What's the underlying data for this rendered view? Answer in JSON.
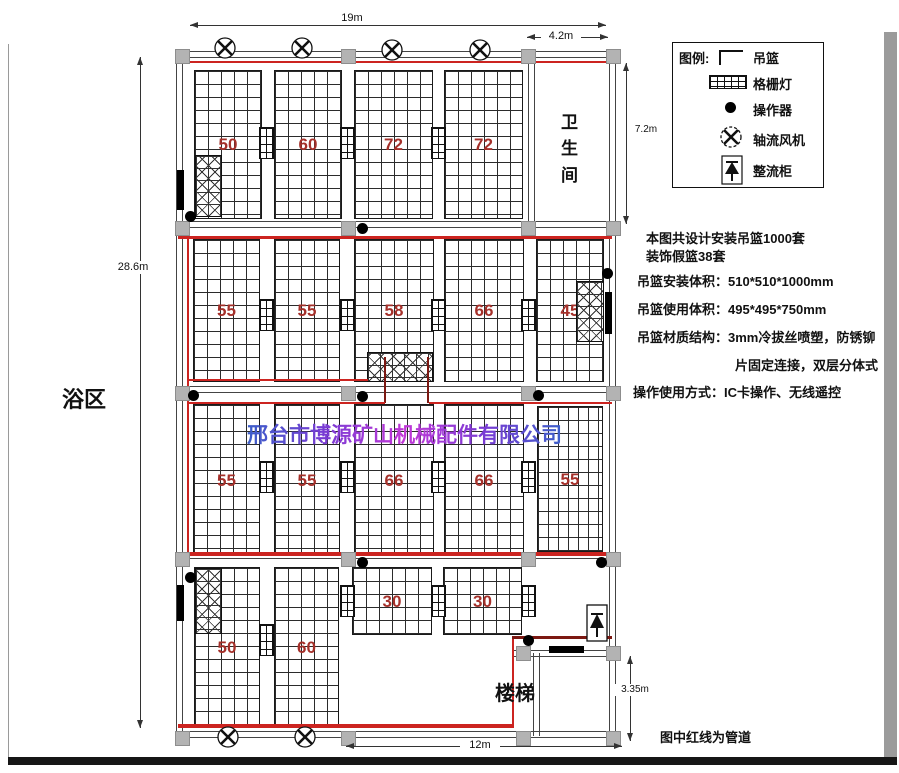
{
  "watermark": "邢台市博源矿山机械配件有限公司",
  "note": "图中红线为管道",
  "rooms": {
    "bath_area": "浴区",
    "toilet": "卫生间",
    "stairs": "楼梯"
  },
  "dims": {
    "top": "19m",
    "top_right": "4.2m",
    "right_upper": "7.2m",
    "left": "28.6m",
    "right_lower": "3.35m",
    "bottom": "12m"
  },
  "legend": {
    "title": "图例:",
    "items": [
      {
        "icon": "basket-icon",
        "label": "吊篮"
      },
      {
        "icon": "grille-light-icon",
        "label": "格栅灯"
      },
      {
        "icon": "operator-icon",
        "label": "操作器"
      },
      {
        "icon": "axial-fan-icon",
        "label": "轴流风机"
      },
      {
        "icon": "rectifier-cabinet-icon",
        "label": "整流柜"
      }
    ]
  },
  "specs": {
    "l1": "本图共设计安装吊篮1000套",
    "l2": "装饰假篮38套",
    "l3": "吊篮安装体积：510*510*1000mm",
    "l4": "吊篮使用体积：495*495*750mm",
    "l5": "吊篮材质结构：3mm冷拔丝喷塑，防锈铆",
    "l6": "片固定连接，双层分体式",
    "l7": "操作使用方式：IC卡操作、无线遥控"
  },
  "rows": [
    {
      "blocks": [
        "50",
        "60",
        "72",
        "72"
      ]
    },
    {
      "blocks": [
        "55",
        "55",
        "58",
        "66",
        "45"
      ]
    },
    {
      "blocks": [
        "55",
        "55",
        "66",
        "66",
        "55"
      ]
    },
    {
      "blocks": [
        "50",
        "60",
        "30",
        "30"
      ]
    }
  ],
  "colors": {
    "pipe_red": "#cc2420",
    "pipe_dark_red": "#7c1812",
    "block_number_red": "#a5302a",
    "column_gray": "#b3b3b3",
    "watermark_blue": "#3b5ec9",
    "watermark_magenta": "#c238d8"
  }
}
